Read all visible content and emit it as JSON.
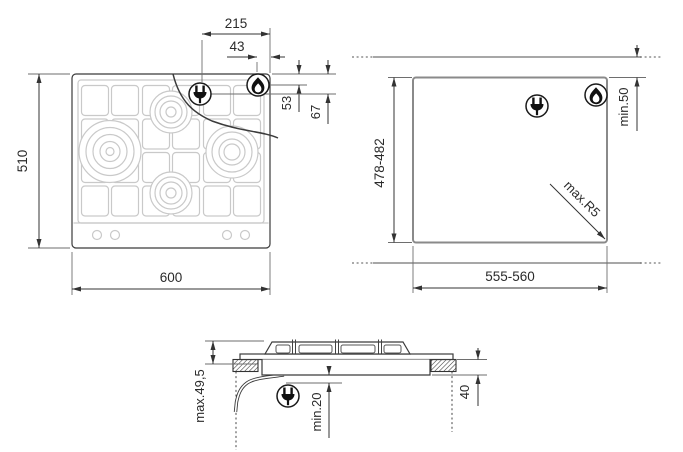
{
  "colors": {
    "line_dark": "#3b3b3b",
    "line_mid": "#8a8a8a",
    "line_light": "#c9c9c9",
    "text": "#2b2b2b"
  },
  "top_view": {
    "overall_width": "600",
    "overall_depth": "510",
    "dim_connection_a": "215",
    "dim_connection_b": "43",
    "dim_connection_c": "53",
    "dim_connection_d": "67"
  },
  "cutout_view": {
    "cutout_width": "555-560",
    "cutout_depth": "478-482",
    "rear_clearance": "min.50",
    "corner_radius": "max.R5"
  },
  "side_view": {
    "max_height": "max.49,5",
    "min_clearance_below": "min.20",
    "recess_depth": "40"
  }
}
